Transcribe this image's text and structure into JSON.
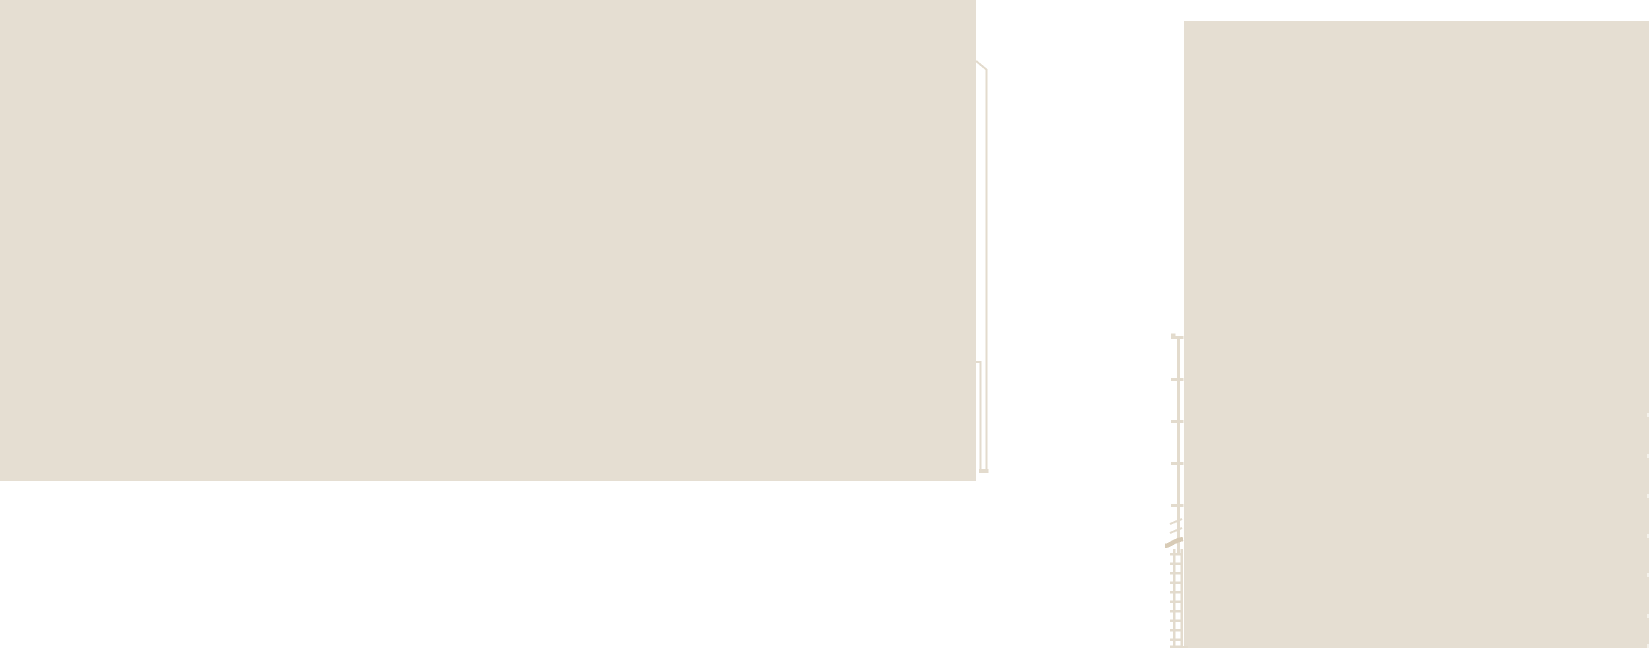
{
  "drawing": {
    "kind": "architectural-elevation-fragment",
    "canvas": {
      "width": 1649,
      "height": 648
    }
  },
  "colors": {
    "background": "#ffffff",
    "wall_fill": "#e5ded2",
    "line_beige": "#e3dbcd",
    "break_mark": "#d8cbb6",
    "edge_nub": "#f4f1ea"
  },
  "left_building": {
    "x": 0,
    "y": 0,
    "w": 976,
    "h": 481
  },
  "right_building": {
    "x": 1184,
    "y": 21,
    "w": 465,
    "h": 627
  },
  "downspout": {
    "diagonal": {
      "x1": 976,
      "y1": 61,
      "x2": 987,
      "y2": 70
    },
    "outer_line": {
      "x": 985.5,
      "y": 69,
      "w": 2,
      "h": 404
    },
    "bracket_tick": {
      "x": 976,
      "y": 361,
      "w": 5,
      "h": 2
    },
    "inner_line": {
      "x": 979.5,
      "y": 361,
      "w": 2,
      "h": 112
    },
    "shoe": {
      "x": 979,
      "y": 469,
      "w": 9.5,
      "h": 4
    }
  },
  "standpipe": {
    "cap_lip": {
      "x": 1171,
      "y": 333.5,
      "w": 4.5,
      "h": 3
    },
    "pole": {
      "x": 1177,
      "y": 336,
      "w": 3,
      "h": 217
    },
    "brackets": {
      "x": 1171,
      "w": 12.5,
      "h": 3,
      "ys": [
        336,
        378,
        420,
        462,
        504
      ],
      "item_name": "standpipe-bracket-tick"
    },
    "diag_tick_upper": {
      "x1": 1170,
      "y1": 524,
      "x2": 1182,
      "y2": 519
    },
    "diag_tick_lower": {
      "x1": 1170,
      "y1": 533,
      "x2": 1182,
      "y2": 528
    }
  },
  "break_mark_path": "M1165,546 C1171,545.5 1172,541 1183,539",
  "ladder": {
    "left_rail": {
      "x": 1173,
      "y": 549,
      "w": 2.5,
      "h": 99
    },
    "right_rail": {
      "x": 1180.5,
      "y": 549,
      "w": 2.5,
      "h": 99
    },
    "rungs": {
      "x": 1170,
      "w": 13,
      "h": 2.5,
      "ys": [
        553,
        562.5,
        572,
        581.5,
        591,
        600.5,
        610,
        619.5,
        629,
        638.5,
        645.5
      ],
      "item_name": "ladder-rung"
    },
    "ground_tick": {
      "x": 1170,
      "y": 646,
      "w": 18,
      "h": 2
    }
  },
  "right_edge_nubs": {
    "x": 1647,
    "w": 2,
    "h": 4,
    "ys": [
      413,
      454,
      494,
      534,
      573,
      614,
      644
    ],
    "item_name": "edge-rung-nub"
  }
}
